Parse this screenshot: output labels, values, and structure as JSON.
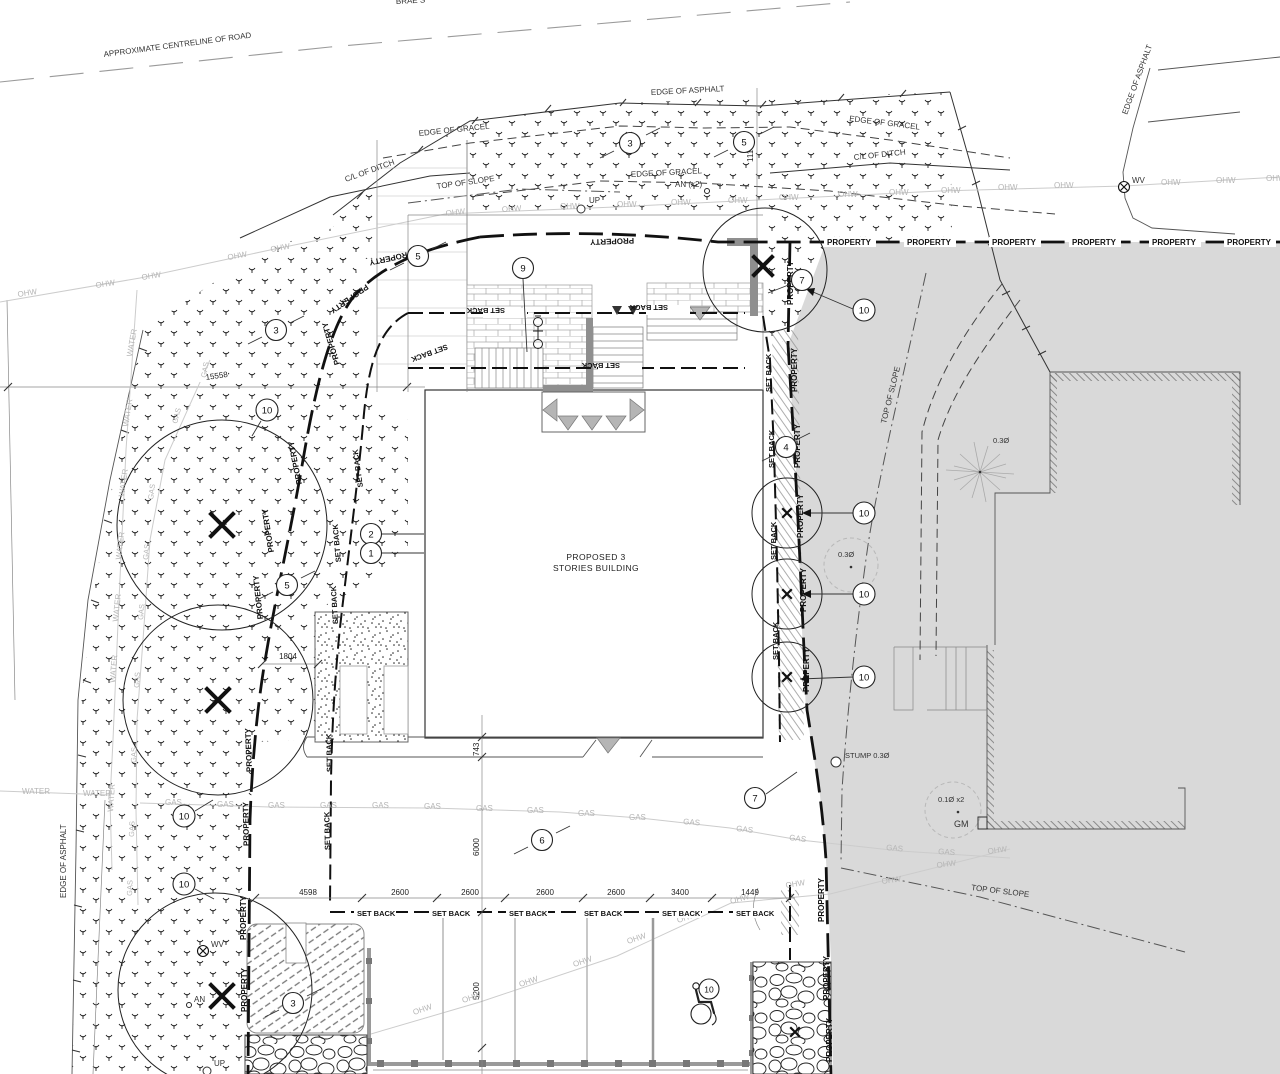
{
  "labels": {
    "road_centerline": "APPROXIMATE CENTRELINE OF ROAD",
    "street_name": "BRAE S",
    "edge_of_asphalt": "EDGE OF ASPHALT",
    "edge_of_gravel": "EDGE OF GRACEL",
    "cl_of_ditch": "C/L OF DITCH",
    "top_of_slope": "TOP OF SLOPE",
    "property": "PROPERTY",
    "set_back": "SET BACK",
    "ohw": "OHW",
    "gas": "GAS",
    "water": "WATER",
    "up": "UP",
    "wv": "WV",
    "an": "AN",
    "an_x2": "AN (x2)",
    "gm": "GM",
    "stump": "STUMP 0.3Ø",
    "dia_03": "0.3Ø",
    "dia_01_x2": "0.1Ø x2"
  },
  "building": {
    "line1": "PROPOSED 3",
    "line2": "STORIES BUILDING"
  },
  "dimensions": {
    "d15558": "15558",
    "d11179": "11179",
    "d1804": "1804",
    "d743": "743",
    "d6000": "6000",
    "d5200": "5200",
    "d4598": "4598",
    "d2600": "2600",
    "d3400": "3400",
    "d1449": "1449"
  },
  "keynotes": {
    "k1": "1",
    "k2": "2",
    "k3": "3",
    "k4": "4",
    "k5": "5",
    "k6": "6",
    "k7": "7",
    "k9": "9",
    "k10": "10"
  },
  "colors": {
    "lot_gray": "#d9d9d9",
    "utility_line": "#cccccc",
    "utility_label": "#b5b5b5",
    "ink": "#111111"
  },
  "icons": {
    "water_valve": "circled-x",
    "wheelchair": "accessible-parking-figure",
    "gas_meter": "gm-square",
    "tree_remove": "x-mark"
  }
}
